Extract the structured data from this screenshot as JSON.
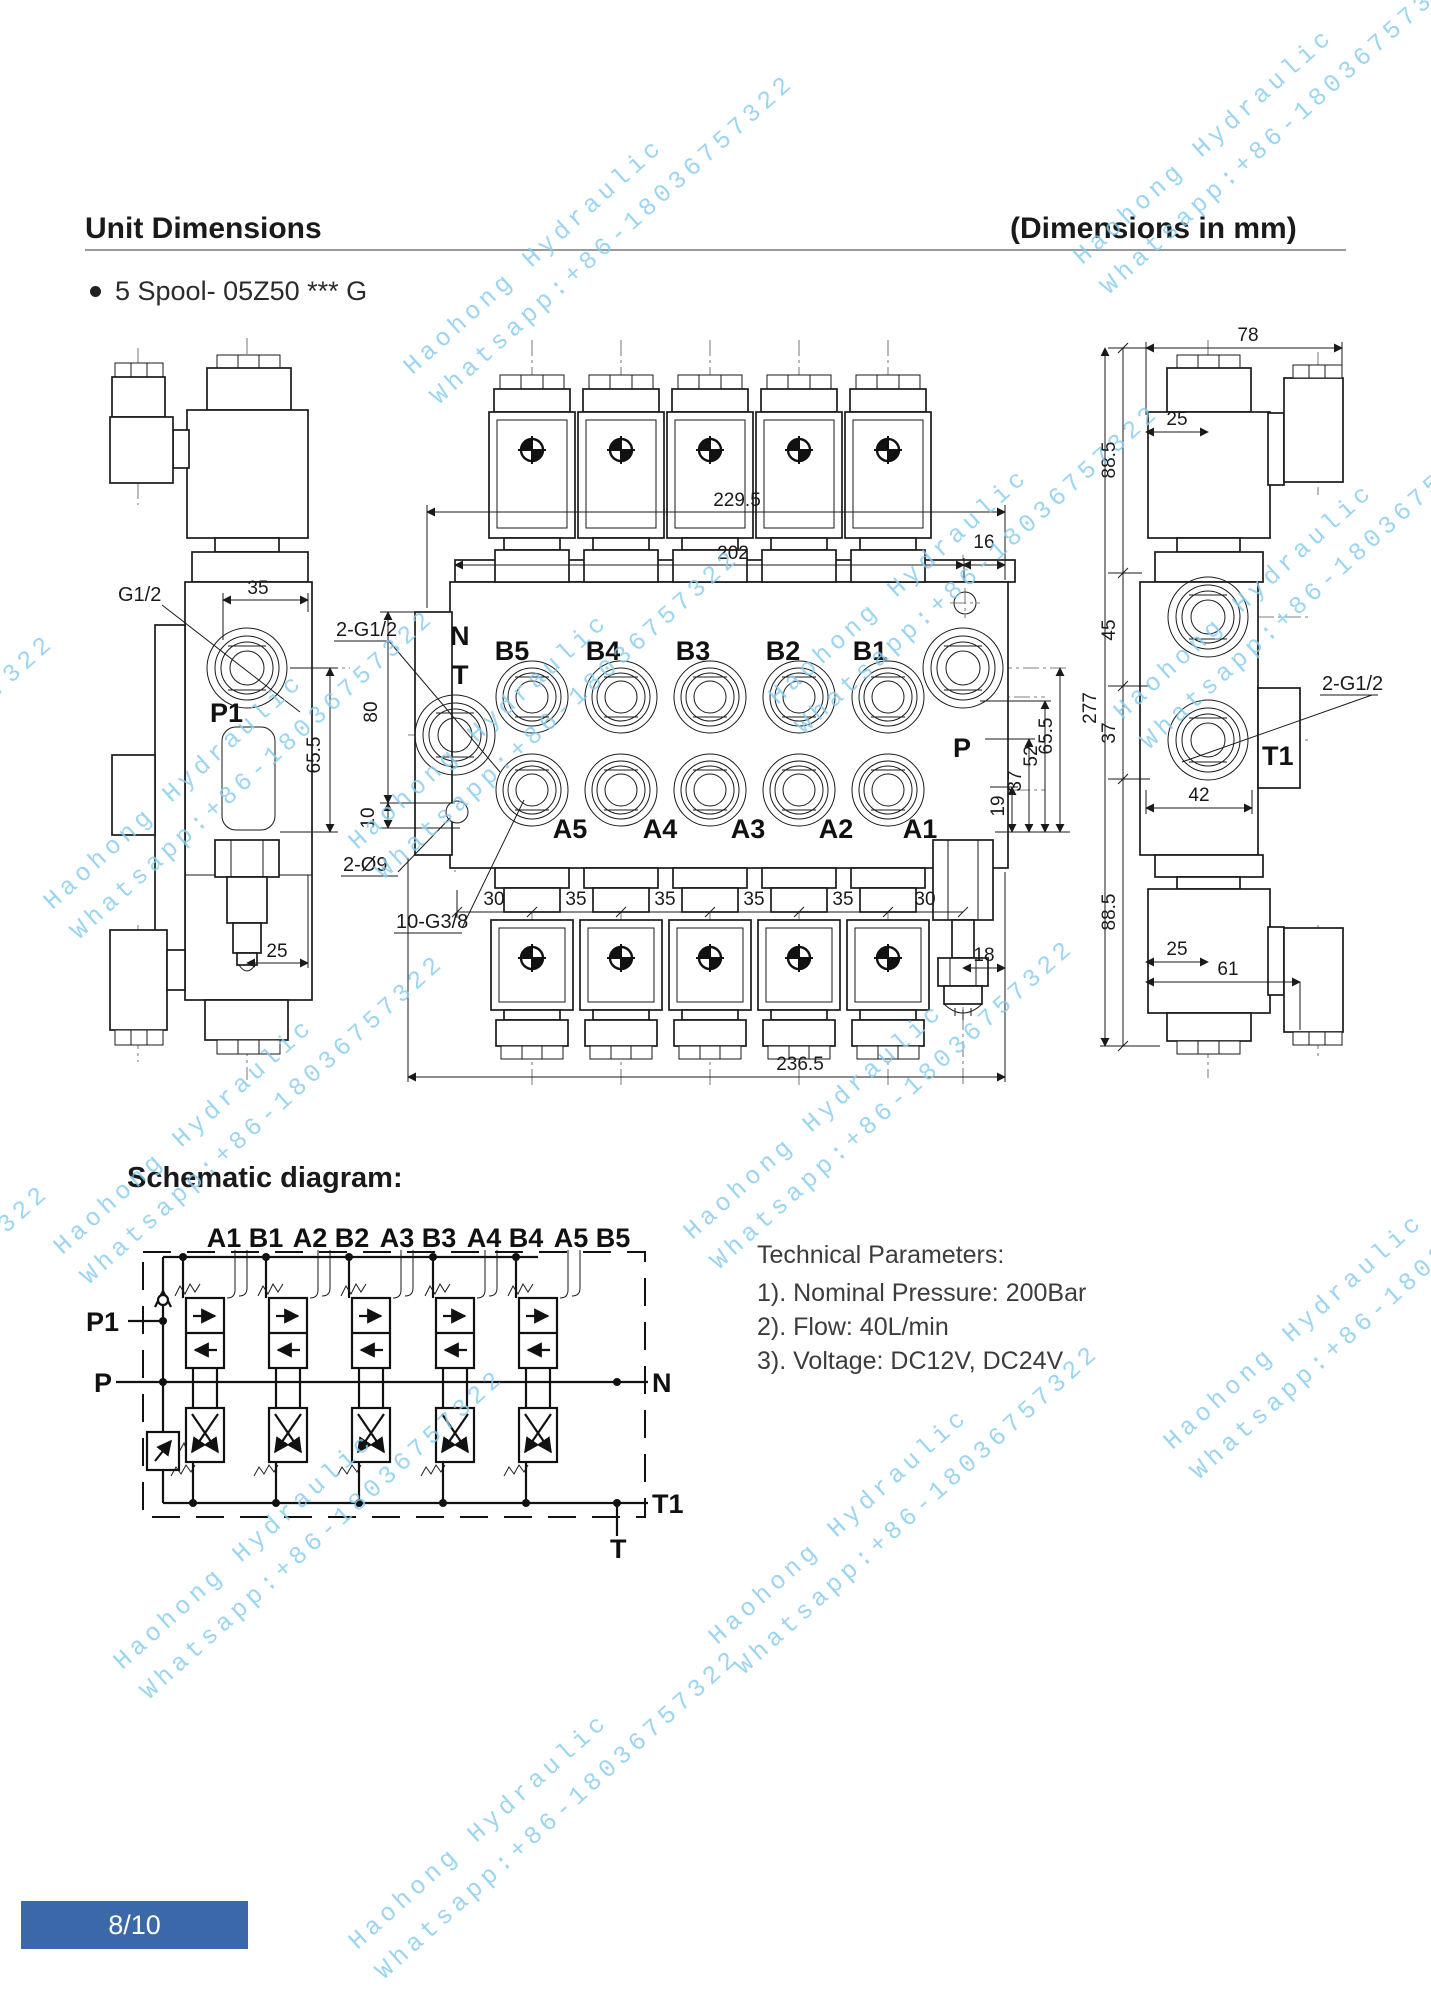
{
  "page": {
    "title": "Unit Dimensions",
    "units_note": "(Dimensions in mm)",
    "bullet": "5 Spool- 05Z50 *** G",
    "footer_page": "8/10"
  },
  "watermark": {
    "line1": "Haohong Hydraulic",
    "line2": "Whatsapp:+86-18036757322"
  },
  "left_view": {
    "g12": "G1/2",
    "p1": "P1",
    "dim35": "35",
    "dim655": "65.5",
    "dim25": "25"
  },
  "front_view": {
    "n": "N",
    "t": "T",
    "p": "P",
    "g12x2": "2-G1/2",
    "o9": "2-Ø9",
    "g38": "10-G3/8",
    "ports_b": [
      "B5",
      "B4",
      "B3",
      "B2",
      "B1"
    ],
    "ports_a": [
      "A5",
      "A4",
      "A3",
      "A2",
      "A1"
    ],
    "dim2295": "229.5",
    "dim202": "202",
    "dim16": "16",
    "dim80": "80",
    "dim10": "10",
    "seg": [
      "30",
      "35",
      "35",
      "35",
      "35",
      "30"
    ],
    "dim18": "18",
    "dim2365": "236.5",
    "dim19": "19",
    "dim37": "37",
    "dim52": "52",
    "dim655": "65.5"
  },
  "right_view": {
    "t1": "T1",
    "g12x2": "2-G1/2",
    "dim78": "78",
    "dim885_top": "88.5",
    "dim25_top": "25",
    "dim277": "277",
    "dim45": "45",
    "dim37": "37",
    "dim42": "42",
    "dim885_bot": "88.5",
    "dim25_bot": "25",
    "dim61": "61"
  },
  "schematic": {
    "heading": "Schematic diagram:",
    "sections": [
      "A1 B1",
      "A2 B2",
      "A3 B3",
      "A4 B4",
      "A5 B5"
    ],
    "p1": "P1",
    "p": "P",
    "n": "N",
    "t1": "T1",
    "t": "T"
  },
  "tech": {
    "heading": "Technical Parameters:",
    "items": [
      "1). Nominal Pressure: 200Bar",
      "2). Flow: 40L/min",
      "3). Voltage: DC12V, DC24V"
    ]
  }
}
